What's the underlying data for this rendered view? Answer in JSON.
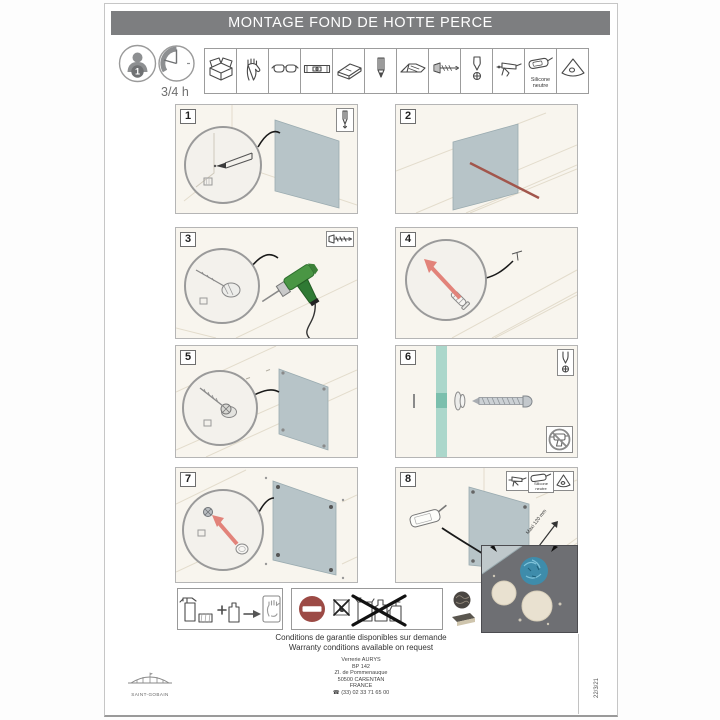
{
  "page": {
    "title": "MONTAGE FOND DE HOTTE PERCE",
    "brand": "SAINT-GOBAIN",
    "date_code": "22/3/21"
  },
  "prep": {
    "people_count": "1",
    "duration": "3/4 h",
    "silicone_line1": "Silicone",
    "silicone_line2": "neutre",
    "tools": [
      "toolbox-icon",
      "gloves-icon",
      "safety-glasses-icon",
      "spirit-level-icon",
      "try-square-icon",
      "pencil-icon",
      "utility-knife-icon",
      "drill-bit-icon",
      "screwdriver-bit-icon",
      "caulking-gun-icon",
      "silicone-tube-icon",
      "smoothing-triangle-icon"
    ]
  },
  "steps": [
    {
      "number": "1",
      "tool_badge": "pencil-icon"
    },
    {
      "number": "2"
    },
    {
      "number": "3",
      "tool_badge": "drill-bit-icon"
    },
    {
      "number": "4"
    },
    {
      "number": "5"
    },
    {
      "number": "6",
      "tool_badge": "screwdriver-bit-icon",
      "warning": "no-power-drill-icon"
    },
    {
      "number": "7"
    },
    {
      "number": "8",
      "tool_badges": [
        "caulking-gun-icon",
        "silicone-tube-icon",
        "smoothing-triangle-icon"
      ],
      "dimension_label": "Maxi 120 mm",
      "silicone_line1": "Silicone",
      "silicone_line2": "neutre"
    }
  ],
  "care": {
    "allowed_icons": [
      "spray-cleaner-icon",
      "sponge-icon",
      "plus-sign",
      "bottle-icon",
      "arrow-right",
      "soft-cloth-hand-icon"
    ],
    "forbidden_icons": [
      "no-entry-icon",
      "flammable-crossed-icon",
      "solvent-bottles-crossed-icon",
      "steel-wool-icon",
      "scouring-pad-icon"
    ]
  },
  "footer": {
    "warranty_fr": "Conditions de garantie disponibles sur demande",
    "warranty_en": "Warranty conditions available on request",
    "company": "Verrerie AURYS",
    "po_box": "BP 142",
    "street": "ZI. de Pommenauque",
    "city": "50500 CARENTAN",
    "country": "FRANCE",
    "phone_icon": "☎",
    "phone": "(33) 02 33 71 65 00"
  },
  "colors": {
    "title_bar": "#7d7e80",
    "glass_panel": "#b7c4c8",
    "glass_section_teal": "#abd7cb",
    "accent_red_arrow": "#e2837a",
    "marker_red_line": "#a2564c",
    "no_entry_red": "#9c4a45",
    "drill_green": "#4a9644",
    "inset_background": "#6e6f73"
  }
}
